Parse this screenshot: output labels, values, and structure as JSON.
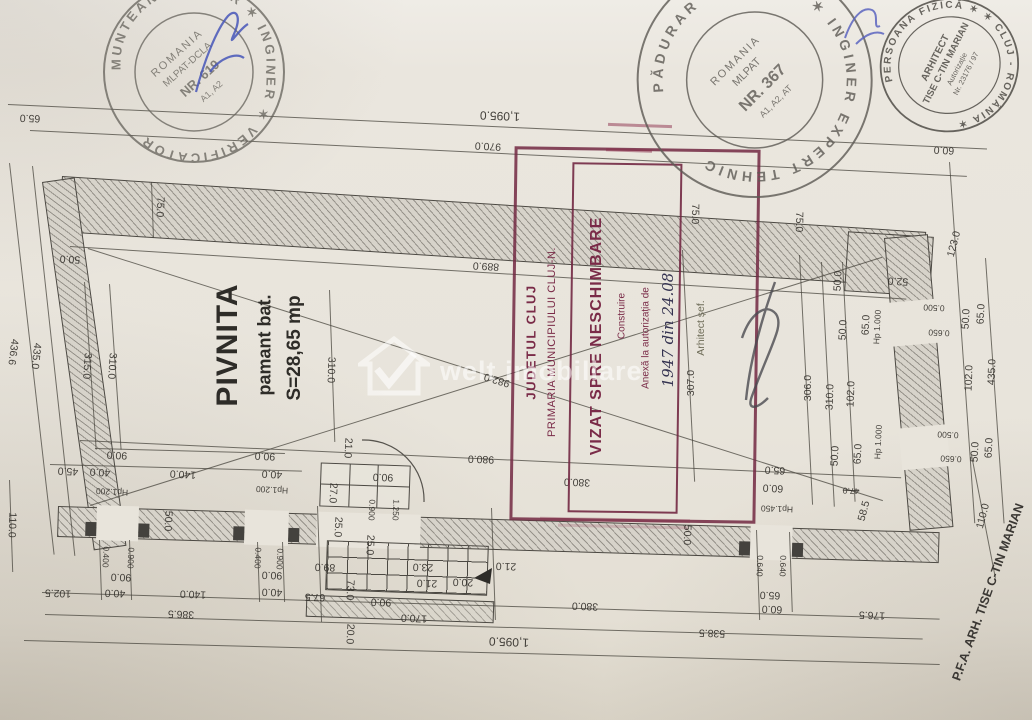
{
  "watermark": {
    "text": "welt imobiliare",
    "logo": "house-check-icon"
  },
  "room": {
    "name": "PIVNITA",
    "material": "pamant bat.",
    "area": "S=28,65 mp"
  },
  "approval_stamp": {
    "county": "JUDETUL CLUJ",
    "city": "PRIMARIA MUNICIPIULUI CLUJ-N.",
    "box_title": "VIZAT SPRE NESCHIMBARE",
    "box_subtitle": "Construire",
    "annex_line": "Anexă la autorizația de",
    "handwritten_number": "1947 din 24.08",
    "signed_by": "Arhitect șef.",
    "color": "#7a2b48"
  },
  "verifier_stamp": {
    "ring": "MUNTEANU M. MAR ✶ INGINER ✶ VERIFICATOR",
    "country": "ROMANIA",
    "org": "MLPAT-DCLA",
    "number": "NR. 619",
    "grades": "A1, A2"
  },
  "expert_stamp": {
    "ring": "PĂDURAR V. VASILE ✶ INGINER EXPERT TEHNIC",
    "country": "ROMANIA",
    "org": "MLPAT",
    "number": "NR. 367",
    "grades": "A1, A2, AT"
  },
  "architect_stamp": {
    "ring": "PERSOANA FIZICĂ ✶ ✶ CLUJ - ROMÂNIA ✶",
    "line1": "ARHITECT",
    "line2": "TISE C-TIN MARIAN",
    "line3": "Autorizație",
    "line4": "Nr. 23176 / 97"
  },
  "credit": {
    "text": "P.F.A. ARH. TISE C-TIN MARIAN"
  },
  "plan": {
    "labels": [
      {
        "t": "65.0",
        "x": 30,
        "y": 118,
        "r": 182
      },
      {
        "t": "1,095.0",
        "x": 500,
        "y": 116,
        "r": 182,
        "s": "lg"
      },
      {
        "t": "970.0",
        "x": 488,
        "y": 146,
        "r": 183
      },
      {
        "t": "889.0",
        "x": 486,
        "y": 266,
        "r": 183
      },
      {
        "t": "60.0",
        "x": 944,
        "y": 150,
        "r": 183
      },
      {
        "t": "75.0",
        "x": 160,
        "y": 207,
        "r": 93
      },
      {
        "t": "50.0",
        "x": 70,
        "y": 259,
        "r": 183
      },
      {
        "t": "436.6",
        "x": 13,
        "y": 352,
        "r": 97
      },
      {
        "t": "435.0",
        "x": 36,
        "y": 356,
        "r": 96
      },
      {
        "t": "315.0",
        "x": 87,
        "y": 366,
        "r": 94
      },
      {
        "t": "310.0",
        "x": 112,
        "y": 366,
        "r": 94
      },
      {
        "t": "310.0",
        "x": 331,
        "y": 370,
        "r": 92
      },
      {
        "t": "982.0",
        "x": 497,
        "y": 380,
        "r": 197
      },
      {
        "t": "980.0",
        "x": 481,
        "y": 459,
        "r": 182
      },
      {
        "t": "75.0",
        "x": 695,
        "y": 214,
        "r": 91
      },
      {
        "t": "75.0",
        "x": 799,
        "y": 222,
        "r": 91
      },
      {
        "t": "307.0",
        "x": 691,
        "y": 383,
        "r": 270
      },
      {
        "t": "306.0",
        "x": 808,
        "y": 388,
        "r": 270
      },
      {
        "t": "310.0",
        "x": 830,
        "y": 397,
        "r": 272
      },
      {
        "t": "102.0",
        "x": 851,
        "y": 394,
        "r": 272
      },
      {
        "t": "52.0",
        "x": 898,
        "y": 281,
        "r": 183
      },
      {
        "t": "123.0",
        "x": 954,
        "y": 244,
        "r": 285
      },
      {
        "t": "50.0",
        "x": 838,
        "y": 281,
        "r": 273
      },
      {
        "t": "65.0",
        "x": 866,
        "y": 325,
        "r": 273
      },
      {
        "t": "50.0",
        "x": 843,
        "y": 330,
        "r": 273
      },
      {
        "t": "Hp 1.000",
        "x": 877,
        "y": 327,
        "r": 273,
        "s": "sm"
      },
      {
        "t": "0.500",
        "x": 934,
        "y": 308,
        "r": 183,
        "s": "sm"
      },
      {
        "t": "0.650",
        "x": 939,
        "y": 333,
        "r": 183,
        "s": "sm"
      },
      {
        "t": "50.0",
        "x": 966,
        "y": 319,
        "r": 273
      },
      {
        "t": "65.0",
        "x": 981,
        "y": 314,
        "r": 273
      },
      {
        "t": "435.0",
        "x": 992,
        "y": 372,
        "r": 272
      },
      {
        "t": "102.0",
        "x": 969,
        "y": 378,
        "r": 272
      },
      {
        "t": "Hp 1.000",
        "x": 878,
        "y": 442,
        "r": 273,
        "s": "sm"
      },
      {
        "t": "0.500",
        "x": 948,
        "y": 435,
        "r": 183,
        "s": "sm"
      },
      {
        "t": "0.650",
        "x": 951,
        "y": 459,
        "r": 183,
        "s": "sm"
      },
      {
        "t": "65.0",
        "x": 858,
        "y": 454,
        "r": 273
      },
      {
        "t": "50.0",
        "x": 835,
        "y": 456,
        "r": 273
      },
      {
        "t": "50.0",
        "x": 975,
        "y": 452,
        "r": 273
      },
      {
        "t": "65.0",
        "x": 989,
        "y": 448,
        "r": 273
      },
      {
        "t": "110.0",
        "x": 983,
        "y": 516,
        "r": 285
      },
      {
        "t": "47.0",
        "x": 851,
        "y": 491,
        "r": 183,
        "s": "sm strike"
      },
      {
        "t": "58.5",
        "x": 864,
        "y": 511,
        "r": 285
      },
      {
        "t": "65.0",
        "x": 775,
        "y": 470,
        "r": 183
      },
      {
        "t": "60.0",
        "x": 773,
        "y": 488,
        "r": 183
      },
      {
        "t": "Hp1.450",
        "x": 777,
        "y": 509,
        "r": 182,
        "s": "sm"
      },
      {
        "t": "0.640",
        "x": 760,
        "y": 566,
        "r": 92,
        "s": "sm"
      },
      {
        "t": "0.640",
        "x": 783,
        "y": 566,
        "r": 92,
        "s": "sm"
      },
      {
        "t": "50.0",
        "x": 687,
        "y": 535,
        "r": 92
      },
      {
        "t": "380.0",
        "x": 577,
        "y": 482,
        "r": 182
      },
      {
        "t": "90.0",
        "x": 117,
        "y": 455,
        "r": 183
      },
      {
        "t": "45.0",
        "x": 68,
        "y": 471,
        "r": 183
      },
      {
        "t": "40.0",
        "x": 100,
        "y": 472,
        "r": 183
      },
      {
        "t": "140.0",
        "x": 183,
        "y": 474,
        "r": 183
      },
      {
        "t": "90.0",
        "x": 265,
        "y": 456,
        "r": 183
      },
      {
        "t": "40.0",
        "x": 272,
        "y": 474,
        "r": 183
      },
      {
        "t": "Hp1.200",
        "x": 112,
        "y": 492,
        "r": 183,
        "s": "sm"
      },
      {
        "t": "Hp1.200",
        "x": 272,
        "y": 490,
        "r": 183,
        "s": "sm"
      },
      {
        "t": "50.0",
        "x": 168,
        "y": 521,
        "r": 93
      },
      {
        "t": "0.400",
        "x": 106,
        "y": 557,
        "r": 93,
        "s": "sm"
      },
      {
        "t": "0.900",
        "x": 131,
        "y": 558,
        "r": 93,
        "s": "sm"
      },
      {
        "t": "90.0",
        "x": 121,
        "y": 577,
        "r": 182
      },
      {
        "t": "40.0",
        "x": 115,
        "y": 593,
        "r": 182
      },
      {
        "t": "140.0",
        "x": 193,
        "y": 594,
        "r": 182
      },
      {
        "t": "102.5",
        "x": 58,
        "y": 593,
        "r": 182
      },
      {
        "t": "0.400",
        "x": 258,
        "y": 558,
        "r": 93,
        "s": "sm"
      },
      {
        "t": "0.900",
        "x": 280,
        "y": 559,
        "r": 93,
        "s": "sm"
      },
      {
        "t": "90.0",
        "x": 272,
        "y": 575,
        "r": 182
      },
      {
        "t": "40.0",
        "x": 272,
        "y": 592,
        "r": 182
      },
      {
        "t": "386.5",
        "x": 181,
        "y": 614,
        "r": 182
      },
      {
        "t": "67.5",
        "x": 315,
        "y": 597,
        "r": 182
      },
      {
        "t": "73.0",
        "x": 350,
        "y": 590,
        "r": 93
      },
      {
        "t": "89.0",
        "x": 325,
        "y": 567,
        "r": 182
      },
      {
        "t": "25.0",
        "x": 338,
        "y": 527,
        "r": 93
      },
      {
        "t": "25.0",
        "x": 370,
        "y": 545,
        "r": 93
      },
      {
        "t": "21.0",
        "x": 348,
        "y": 448,
        "r": 93
      },
      {
        "t": "90.0",
        "x": 383,
        "y": 477,
        "r": 182
      },
      {
        "t": "27.0",
        "x": 333,
        "y": 493,
        "r": 93
      },
      {
        "t": "0.900",
        "x": 372,
        "y": 510,
        "r": 93,
        "s": "sm"
      },
      {
        "t": "1.250",
        "x": 396,
        "y": 510,
        "r": 93,
        "s": "sm"
      },
      {
        "t": "23.0",
        "x": 423,
        "y": 567,
        "r": 182
      },
      {
        "t": "21.0",
        "x": 506,
        "y": 566,
        "r": 182
      },
      {
        "t": "21.0",
        "x": 427,
        "y": 583,
        "r": 182
      },
      {
        "t": "20.0",
        "x": 463,
        "y": 582,
        "r": 182
      },
      {
        "t": "90.0",
        "x": 381,
        "y": 602,
        "r": 182
      },
      {
        "t": "170.0",
        "x": 414,
        "y": 618,
        "r": 182
      },
      {
        "t": "20.0",
        "x": 350,
        "y": 634,
        "r": 93
      },
      {
        "t": "1,095.0",
        "x": 509,
        "y": 642,
        "r": 182,
        "s": "lg"
      },
      {
        "t": "538.5",
        "x": 712,
        "y": 633,
        "r": 182
      },
      {
        "t": "380.0",
        "x": 585,
        "y": 606,
        "r": 182
      },
      {
        "t": "60.0",
        "x": 772,
        "y": 609,
        "r": 182
      },
      {
        "t": "65.0",
        "x": 770,
        "y": 595,
        "r": 182
      },
      {
        "t": "176.5",
        "x": 872,
        "y": 615,
        "r": 182
      },
      {
        "t": "110.0",
        "x": 12,
        "y": 525,
        "r": 92
      }
    ],
    "lines": [
      {
        "x": 8,
        "y": 104,
        "w": 980,
        "r": 2.6
      },
      {
        "x": 30,
        "y": 130,
        "w": 938,
        "r": 2.8
      },
      {
        "x": 70,
        "y": 246,
        "w": 838,
        "r": 3.6
      },
      {
        "x": 80,
        "y": 440,
        "w": 822,
        "r": 2.6
      },
      {
        "x": 88,
        "y": 248,
        "w": 834,
        "r": 17.6
      },
      {
        "x": 90,
        "y": 505,
        "w": 830,
        "r": -17.4
      },
      {
        "x": 42,
        "y": 592,
        "w": 898,
        "r": 1.7
      },
      {
        "x": 45,
        "y": 614,
        "w": 878,
        "r": 1.6
      },
      {
        "x": 24,
        "y": 640,
        "w": 916,
        "r": 1.5
      },
      {
        "x": 10,
        "y": 163,
        "w": 394,
        "r": 83.5
      },
      {
        "x": 33,
        "y": 166,
        "w": 392,
        "r": 83.8
      },
      {
        "x": 950,
        "y": 162,
        "w": 362,
        "r": 86
      },
      {
        "x": 986,
        "y": 258,
        "w": 266,
        "r": 86
      },
      {
        "x": 683,
        "y": 250,
        "w": 232,
        "r": 87
      },
      {
        "x": 800,
        "y": 255,
        "w": 250,
        "r": 87
      },
      {
        "x": 822,
        "y": 262,
        "w": 245,
        "r": 87
      },
      {
        "x": 843,
        "y": 262,
        "w": 240,
        "r": 87
      },
      {
        "x": 85,
        "y": 282,
        "w": 168,
        "r": 86
      },
      {
        "x": 110,
        "y": 284,
        "w": 166,
        "r": 86
      },
      {
        "x": 330,
        "y": 290,
        "w": 152,
        "r": 88
      },
      {
        "x": 10,
        "y": 480,
        "w": 92,
        "r": 88
      },
      {
        "x": 152,
        "y": 182,
        "w": 56,
        "r": 88
      },
      {
        "x": 972,
        "y": 455,
        "w": 125,
        "r": 79
      },
      {
        "x": 318,
        "y": 506,
        "w": 116,
        "r": 88
      },
      {
        "x": 492,
        "y": 508,
        "w": 112,
        "r": 88
      },
      {
        "x": 757,
        "y": 530,
        "w": 90,
        "r": 88
      },
      {
        "x": 790,
        "y": 532,
        "w": 80,
        "r": 88
      },
      {
        "x": 100,
        "y": 540,
        "w": 60,
        "r": 88
      },
      {
        "x": 130,
        "y": 540,
        "w": 60,
        "r": 88
      },
      {
        "x": 258,
        "y": 542,
        "w": 60,
        "r": 88
      },
      {
        "x": 283,
        "y": 542,
        "w": 60,
        "r": 88
      },
      {
        "x": 50,
        "y": 464,
        "w": 252,
        "r": 1.5
      },
      {
        "x": 95,
        "y": 448,
        "w": 190,
        "r": 1.5
      }
    ]
  }
}
